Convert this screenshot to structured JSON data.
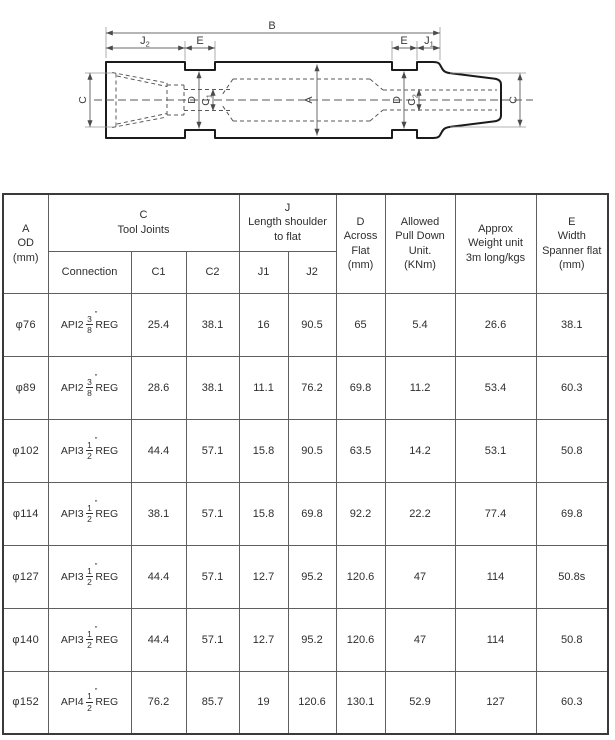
{
  "diagram": {
    "b": "B",
    "j2": {
      "main": "J",
      "sub": "2"
    },
    "e_left": "E",
    "e_right": "E",
    "j1": {
      "main": "J",
      "sub": "1"
    },
    "c_left": "C",
    "c_right": "C",
    "a": "A",
    "d_left": "D",
    "d_right": "D",
    "c1": {
      "main": "C",
      "sub": "1"
    },
    "c2": {
      "main": "C",
      "sub": "2"
    }
  },
  "table": {
    "conn_mark": "″",
    "header": {
      "a_od": "A\nOD\n(mm)",
      "c_group": "C\nTool Joints",
      "j_group": "J\nLength shoulder\nto flat",
      "d": "D\nAcross\nFlat\n(mm)",
      "allowed": "Allowed\nPull Down\nUnit.\n(KNm)",
      "approx": "Approx\nWeight unit\n3m long/kgs",
      "e": "E\nWidth\nSpanner flat\n(mm)",
      "sub": {
        "connection": "Connection",
        "c1": "C1",
        "c2": "C2",
        "j1": "J1",
        "j2": "J2"
      }
    },
    "rows": [
      {
        "od": "φ76",
        "conn": {
          "pre": "API2",
          "num": "3",
          "den": "8",
          "suf": "REG"
        },
        "c1": "25.4",
        "c2": "38.1",
        "j1": "16",
        "j2": "90.5",
        "d": "65",
        "pull": "5.4",
        "weight": "26.6",
        "e": "38.1"
      },
      {
        "od": "φ89",
        "conn": {
          "pre": "API2",
          "num": "3",
          "den": "8",
          "suf": "REG"
        },
        "c1": "28.6",
        "c2": "38.1",
        "j1": "11.1",
        "j2": "76.2",
        "d": "69.8",
        "pull": "11.2",
        "weight": "53.4",
        "e": "60.3"
      },
      {
        "od": "φ102",
        "conn": {
          "pre": "API3",
          "num": "1",
          "den": "2",
          "suf": "REG"
        },
        "c1": "44.4",
        "c2": "57.1",
        "j1": "15.8",
        "j2": "90.5",
        "d": "63.5",
        "pull": "14.2",
        "weight": "53.1",
        "e": "50.8"
      },
      {
        "od": "φ114",
        "conn": {
          "pre": "API3",
          "num": "1",
          "den": "2",
          "suf": "REG"
        },
        "c1": "38.1",
        "c2": "57.1",
        "j1": "15.8",
        "j2": "69.8",
        "d": "92.2",
        "pull": "22.2",
        "weight": "77.4",
        "e": "69.8"
      },
      {
        "od": "φ127",
        "conn": {
          "pre": "API3",
          "num": "1",
          "den": "2",
          "suf": "REG"
        },
        "c1": "44.4",
        "c2": "57.1",
        "j1": "12.7",
        "j2": "95.2",
        "d": "120.6",
        "pull": "47",
        "weight": "114",
        "e": "50.8s"
      },
      {
        "od": "φ140",
        "conn": {
          "pre": "API3",
          "num": "1",
          "den": "2",
          "suf": "REG"
        },
        "c1": "44.4",
        "c2": "57.1",
        "j1": "12.7",
        "j2": "95.2",
        "d": "120.6",
        "pull": "47",
        "weight": "114",
        "e": "50.8"
      },
      {
        "od": "φ152",
        "conn": {
          "pre": "API4",
          "num": "1",
          "den": "2",
          "suf": "REG"
        },
        "c1": "76.2",
        "c2": "85.7",
        "j1": "19",
        "j2": "120.6",
        "d": "130.1",
        "pull": "52.9",
        "weight": "127",
        "e": "60.3"
      }
    ]
  }
}
